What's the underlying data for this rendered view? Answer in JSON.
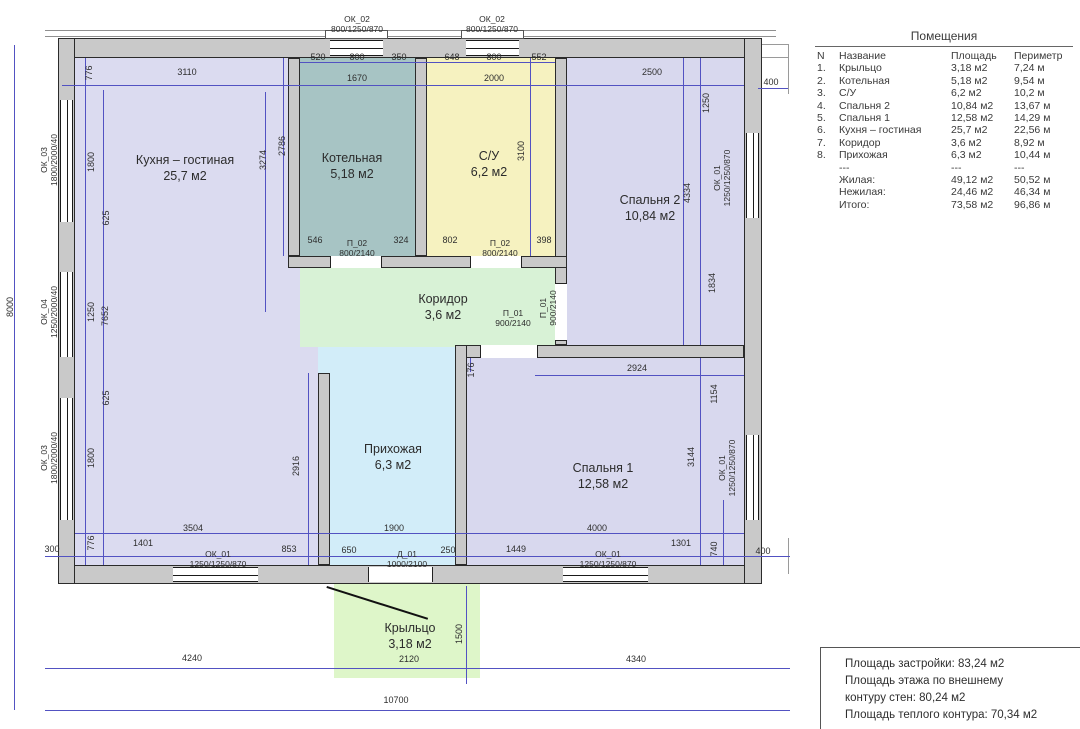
{
  "plan": {
    "colors": {
      "kitchen": "#dbdbf0",
      "boiler": "#a7c4c4",
      "bathroom": "#f6f2c0",
      "bedroom2": "#d8d8ee",
      "bedroom1": "#d8d8ee",
      "corridor": "#d8f2d6",
      "hallway": "#d2edf9",
      "porch": "#def6c9",
      "wall": "#c9c9c9",
      "dim_line": "#5252c2"
    },
    "rooms": [
      {
        "name": "Кухня – гостиная",
        "area": "25,7 м2",
        "x": 185,
        "y": 168
      },
      {
        "name": "Котельная",
        "area": "5,18 м2",
        "x": 352,
        "y": 166
      },
      {
        "name": "С/У",
        "area": "6,2 м2",
        "x": 489,
        "y": 164
      },
      {
        "name": "Спальня 2",
        "area": "10,84 м2",
        "x": 650,
        "y": 208
      },
      {
        "name": "Коридор",
        "area": "3,6 м2",
        "x": 443,
        "y": 307
      },
      {
        "name": "Прихожая",
        "area": "6,3 м2",
        "x": 393,
        "y": 457
      },
      {
        "name": "Спальня 1",
        "area": "12,58 м2",
        "x": 603,
        "y": 476
      },
      {
        "name": "Крыльцо",
        "area": "3,18 м2",
        "x": 410,
        "y": 636
      }
    ],
    "opening_labels": [
      {
        "name": "ОК_02",
        "size": "800/1250/870",
        "x": 357,
        "y": 24
      },
      {
        "name": "ОК_02",
        "size": "800/1250/870",
        "x": 492,
        "y": 24
      },
      {
        "name": "ОК_03",
        "size": "1800/2000/40",
        "x": 49,
        "y": 160,
        "r": 1
      },
      {
        "name": "ОК_04",
        "size": "1250/2000/40",
        "x": 49,
        "y": 312,
        "r": 1
      },
      {
        "name": "ОК_03",
        "size": "1800/2000/40",
        "x": 49,
        "y": 458,
        "r": 1
      },
      {
        "name": "ОК_01",
        "size": "1250/1250/870",
        "x": 722,
        "y": 178,
        "r": 1
      },
      {
        "name": "ОК_01",
        "size": "1250/1250/870",
        "x": 727,
        "y": 468,
        "r": 1
      },
      {
        "name": "ОК_01",
        "size": "1250/1250/870",
        "x": 218,
        "y": 559
      },
      {
        "name": "Д_01",
        "size": "1000/2100",
        "x": 407,
        "y": 559
      },
      {
        "name": "ОК_01",
        "size": "1250/1250/870",
        "x": 608,
        "y": 559
      },
      {
        "name": "П_02",
        "size": "800/2140",
        "x": 357,
        "y": 248
      },
      {
        "name": "П_02",
        "size": "800/2140",
        "x": 500,
        "y": 248
      },
      {
        "name": "П_01",
        "size": "900/2140",
        "x": 513,
        "y": 318
      },
      {
        "name": "П_01",
        "size": "900/2140",
        "x": 548,
        "y": 308,
        "r": 1
      }
    ],
    "dim_labels": [
      {
        "t": "520",
        "x": 318,
        "y": 57
      },
      {
        "t": "800",
        "x": 357,
        "y": 57
      },
      {
        "t": "350",
        "x": 399,
        "y": 57
      },
      {
        "t": "648",
        "x": 452,
        "y": 57
      },
      {
        "t": "800",
        "x": 494,
        "y": 57
      },
      {
        "t": "552",
        "x": 539,
        "y": 57
      },
      {
        "t": "776",
        "x": 89,
        "y": 73,
        "r": 1
      },
      {
        "t": "3110",
        "x": 187,
        "y": 72
      },
      {
        "t": "1670",
        "x": 357,
        "y": 78
      },
      {
        "t": "2000",
        "x": 494,
        "y": 78
      },
      {
        "t": "2500",
        "x": 652,
        "y": 72
      },
      {
        "t": "400",
        "x": 771,
        "y": 82
      },
      {
        "t": "1250",
        "x": 706,
        "y": 103,
        "r": 1
      },
      {
        "t": "2786",
        "x": 282,
        "y": 146,
        "r": 1
      },
      {
        "t": "3274",
        "x": 263,
        "y": 160,
        "r": 1
      },
      {
        "t": "3100",
        "x": 521,
        "y": 151,
        "r": 1
      },
      {
        "t": "4334",
        "x": 687,
        "y": 193,
        "r": 1
      },
      {
        "t": "1834",
        "x": 712,
        "y": 283,
        "r": 1
      },
      {
        "t": "1800",
        "x": 91,
        "y": 162,
        "r": 1
      },
      {
        "t": "625",
        "x": 106,
        "y": 218,
        "r": 1
      },
      {
        "t": "1250",
        "x": 91,
        "y": 312,
        "r": 1
      },
      {
        "t": "7652",
        "x": 105,
        "y": 316,
        "r": 1
      },
      {
        "t": "625",
        "x": 106,
        "y": 398,
        "r": 1
      },
      {
        "t": "1800",
        "x": 91,
        "y": 458,
        "r": 1
      },
      {
        "t": "776",
        "x": 91,
        "y": 543,
        "r": 1
      },
      {
        "t": "300",
        "x": 52,
        "y": 549
      },
      {
        "t": "8000",
        "x": 10,
        "y": 307,
        "r": 1
      },
      {
        "t": "546",
        "x": 315,
        "y": 240
      },
      {
        "t": "324",
        "x": 401,
        "y": 240
      },
      {
        "t": "802",
        "x": 450,
        "y": 240
      },
      {
        "t": "398",
        "x": 544,
        "y": 240
      },
      {
        "t": "2916",
        "x": 296,
        "y": 466,
        "r": 1
      },
      {
        "t": "176",
        "x": 471,
        "y": 370,
        "r": 1
      },
      {
        "t": "2924",
        "x": 637,
        "y": 368
      },
      {
        "t": "1154",
        "x": 714,
        "y": 394,
        "r": 1
      },
      {
        "t": "3144",
        "x": 691,
        "y": 457,
        "r": 1
      },
      {
        "t": "3504",
        "x": 193,
        "y": 528
      },
      {
        "t": "1900",
        "x": 394,
        "y": 528
      },
      {
        "t": "4000",
        "x": 597,
        "y": 528
      },
      {
        "t": "1401",
        "x": 143,
        "y": 543
      },
      {
        "t": "853",
        "x": 289,
        "y": 549
      },
      {
        "t": "650",
        "x": 349,
        "y": 550
      },
      {
        "t": "250",
        "x": 448,
        "y": 550
      },
      {
        "t": "1449",
        "x": 516,
        "y": 549
      },
      {
        "t": "1301",
        "x": 681,
        "y": 543
      },
      {
        "t": "740",
        "x": 714,
        "y": 549,
        "r": 1
      },
      {
        "t": "400",
        "x": 763,
        "y": 551
      },
      {
        "t": "2120",
        "x": 409,
        "y": 659
      },
      {
        "t": "1500",
        "x": 459,
        "y": 634,
        "r": 1
      },
      {
        "t": "4240",
        "x": 192,
        "y": 658
      },
      {
        "t": "4340",
        "x": 636,
        "y": 659
      },
      {
        "t": "10700",
        "x": 396,
        "y": 700
      }
    ]
  },
  "table": {
    "title": "Помещения",
    "headers": [
      "N",
      "Название",
      "Площадь",
      "Периметр"
    ],
    "rows": [
      {
        "n": "1.",
        "name": "Крыльцо",
        "area": "3,18 м2",
        "per": "7,24 м"
      },
      {
        "n": "2.",
        "name": "Котельная",
        "area": "5,18 м2",
        "per": "9,54 м"
      },
      {
        "n": "3.",
        "name": "С/У",
        "area": "6,2 м2",
        "per": "10,2 м"
      },
      {
        "n": "4.",
        "name": "Спальня 2",
        "area": "10,84 м2",
        "per": "13,67 м"
      },
      {
        "n": "5.",
        "name": "Спальня 1",
        "area": "12,58 м2",
        "per": "14,29 м"
      },
      {
        "n": "6.",
        "name": "Кухня – гостиная",
        "area": "25,7 м2",
        "per": "22,56 м"
      },
      {
        "n": "7.",
        "name": "Коридор",
        "area": "3,6 м2",
        "per": "8,92 м"
      },
      {
        "n": "8.",
        "name": "Прихожая",
        "area": "6,3 м2",
        "per": "10,44 м"
      },
      {
        "n": "",
        "name": "---",
        "area": "---",
        "per": "---"
      },
      {
        "n": "",
        "name": "Жилая:",
        "area": "49,12 м2",
        "per": "50,52 м"
      },
      {
        "n": "",
        "name": "Нежилая:",
        "area": "24,46 м2",
        "per": "46,34 м"
      },
      {
        "n": "",
        "name": "Итого:",
        "area": "73,58 м2",
        "per": "96,86 м"
      }
    ]
  },
  "summary": {
    "lines": [
      "Площадь застройки: 83,24 м2",
      "Площадь этажа по внешнему",
      "контуру стен: 80,24 м2",
      "Площадь теплого контура: 70,34 м2"
    ]
  }
}
